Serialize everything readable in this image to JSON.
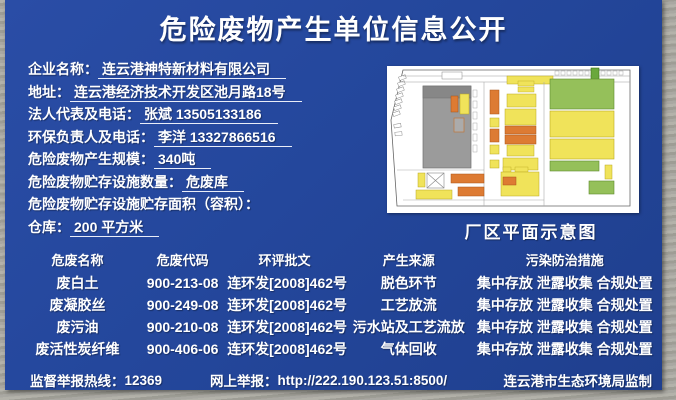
{
  "colors": {
    "board_blue": "#24479c",
    "frame_gray": "#a9a8a0",
    "text": "#ffffff",
    "map_yellow": "#f0e35a",
    "map_orange": "#dd7b33",
    "map_green": "#95c05a",
    "map_gray_building": "#9b9b9b"
  },
  "title": "危险废物产生单位信息公开",
  "fields": [
    {
      "label": "企业名称：",
      "value": "连云港神特新材料有限公司"
    },
    {
      "label": "地址：",
      "value": "连云港经济技术开发区池月路18号"
    },
    {
      "label": "法人代表及电话：",
      "value": "张斌  13505133186"
    },
    {
      "label": "环保负责人及电话：",
      "value": "李洋  13327866516"
    },
    {
      "label": "危险废物产生规模：",
      "value": "340吨"
    },
    {
      "label": "危险废物贮存设施数量：",
      "value": "危废库"
    },
    {
      "label": "危险废物贮存设施贮存面积（容积）：",
      "value": ""
    },
    {
      "label": "仓库：",
      "value": "200 平方米"
    }
  ],
  "map": {
    "caption": "厂区平面示意图"
  },
  "table": {
    "headers": [
      "危废名称",
      "危废代码",
      "环评批文",
      "产生来源",
      "污染防治措施"
    ],
    "rows": [
      [
        "废白土",
        "900-213-08",
        "连环发[2008]462号",
        "脱色环节",
        "集中存放 泄露收集 合规处置"
      ],
      [
        "废凝胶丝",
        "900-249-08",
        "连环发[2008]462号",
        "工艺放流",
        "集中存放 泄露收集 合规处置"
      ],
      [
        "废污油",
        "900-210-08",
        "连环发[2008]462号",
        "污水站及工艺流放",
        "集中存放 泄露收集 合规处置"
      ],
      [
        "废活性炭纤维",
        "900-406-06",
        "连环发[2008]462号",
        "气体回收",
        "集中存放 泄露收集 合规处置"
      ]
    ]
  },
  "footer": {
    "hotline_label": "监督举报热线：",
    "hotline_number": "12369",
    "online_label": "网上举报：",
    "online_url": "http://222.190.123.51:8500/",
    "producer": "连云港市生态环境局监制"
  }
}
